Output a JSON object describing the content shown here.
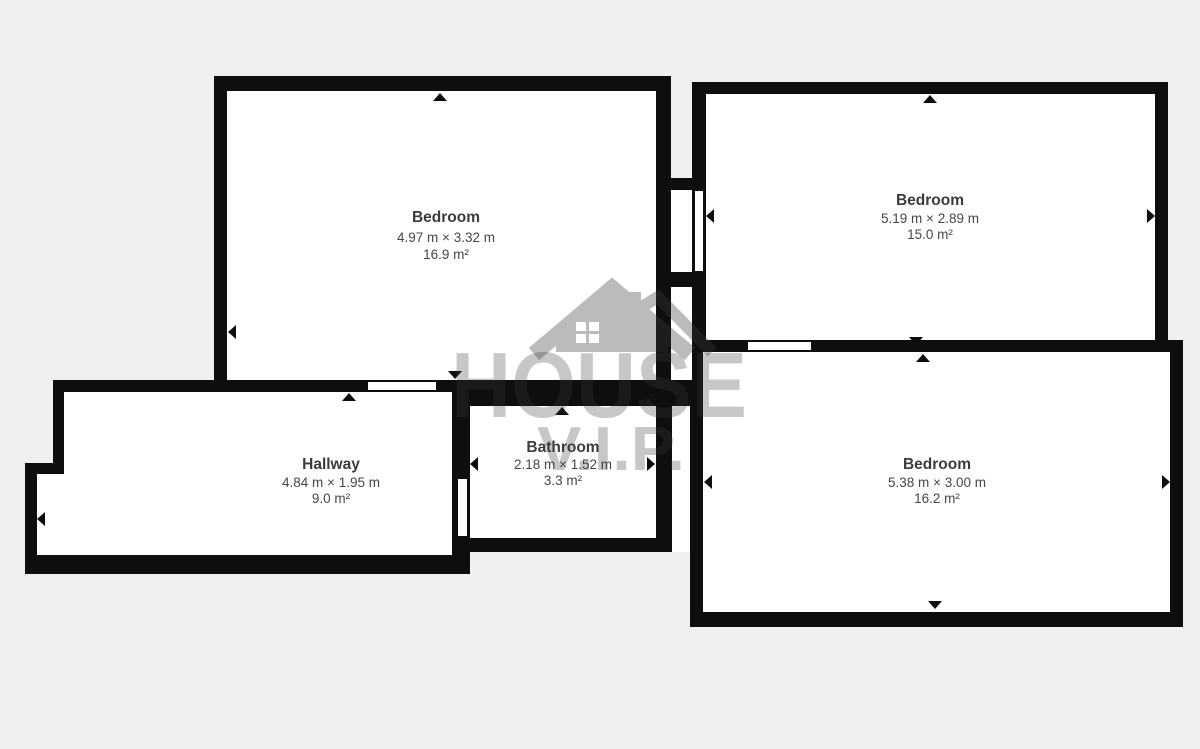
{
  "colors": {
    "background": "#f2f0ee",
    "wall": "#0e0e0e",
    "floor": "#ffffff",
    "watermark": "#3a3a3a",
    "label_text": "#3c3c3c"
  },
  "watermark": {
    "brand_top": "HOUSE",
    "brand_bottom": "V.I.P.",
    "icon": "house-icon"
  },
  "rooms": [
    {
      "id": "bedroom-top-left",
      "name": "Bedroom",
      "dimensions": "4.97 m × 3.32 m",
      "area": "16.9 m²"
    },
    {
      "id": "bedroom-top-right",
      "name": "Bedroom",
      "dimensions": "5.19 m × 2.89 m",
      "area": "15.0 m²"
    },
    {
      "id": "hallway",
      "name": "Hallway",
      "dimensions": "4.84 m × 1.95 m",
      "area": "9.0 m²"
    },
    {
      "id": "bathroom",
      "name": "Bathroom",
      "dimensions": "2.18 m × 1.52 m",
      "area": "3.3 m²"
    },
    {
      "id": "bedroom-bottom-right",
      "name": "Bedroom",
      "dimensions": "5.38 m × 3.00 m",
      "area": "16.2 m²"
    }
  ],
  "icons": {
    "door_marker": "small black triangle on wall",
    "house_icon": "gray gabled house with chimney and window grid"
  }
}
